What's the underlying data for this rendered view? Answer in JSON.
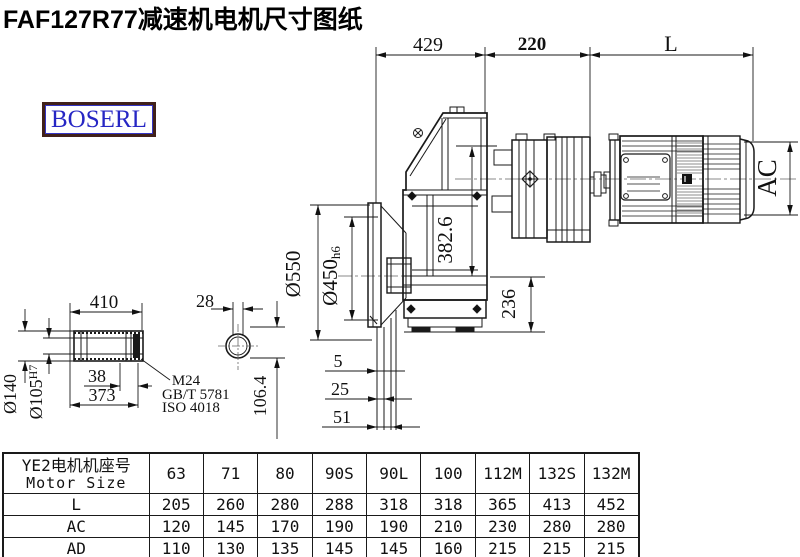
{
  "page_title": "FAF127R77减速机电机尺寸图纸",
  "logo_text": "BOSERL",
  "dims": {
    "d429": "429",
    "d220": "220",
    "dL": "L",
    "ac": "AC",
    "d3826": "382.6",
    "d236": "236",
    "d550": "Ø550",
    "d450": "Ø450",
    "d450_tol": "h6",
    "d5": "5",
    "d25": "25",
    "d51": "51",
    "d410": "410",
    "d28": "28",
    "d140": "Ø140",
    "d105": "Ø105",
    "d105_tol": "H7",
    "d38": "38",
    "d373": "373",
    "d1064": "106.4",
    "thread": "M24",
    "std_gb": "GB/T 5781",
    "std_iso": "ISO 4018"
  },
  "table": {
    "header_cn": "YE2电机机座号",
    "header_en": "Motor Size",
    "columns": [
      "63",
      "71",
      "80",
      "90S",
      "90L",
      "100",
      "112M",
      "132S",
      "132M"
    ],
    "rows": [
      {
        "label": "L",
        "values": [
          "205",
          "260",
          "280",
          "288",
          "318",
          "318",
          "365",
          "413",
          "452"
        ]
      },
      {
        "label": "AC",
        "values": [
          "120",
          "145",
          "170",
          "190",
          "190",
          "210",
          "230",
          "280",
          "280"
        ]
      },
      {
        "label": "AD",
        "values": [
          "110",
          "130",
          "135",
          "145",
          "145",
          "160",
          "215",
          "215",
          "215"
        ]
      }
    ]
  }
}
